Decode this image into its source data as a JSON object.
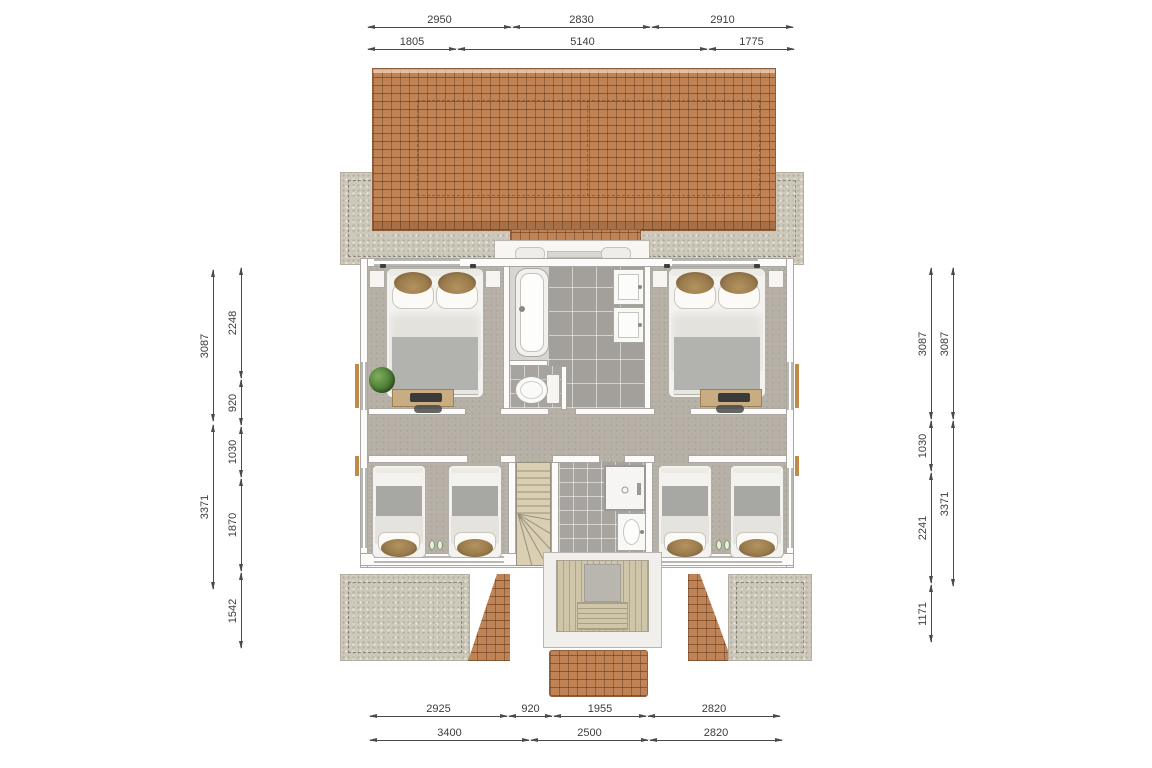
{
  "drawing": {
    "type": "floor-plan",
    "units": "mm"
  },
  "palette": {
    "roof_tile": "#c08355",
    "concrete": "#cdc8ba",
    "room_floor": "#b5afa5",
    "bath_tile": "#a3a09b",
    "stair_wood": "#d9cdb2",
    "deck_wood": "#cfc5a8",
    "wall": "#fcfbf9",
    "desk_wood": "#c9ad82",
    "dimension_text": "#3c3c3c",
    "window_post": "#c08948"
  },
  "dims": {
    "top_row1": [
      "2950",
      "2830",
      "2910"
    ],
    "top_row2": [
      "1805",
      "5140",
      "1775"
    ],
    "bottom_row1": [
      "2925",
      "920",
      "1955",
      "2820"
    ],
    "bottom_row2": [
      "3400",
      "2500",
      "2820"
    ],
    "left_outer": [
      "3087",
      "3371"
    ],
    "left_inner": [
      "2248",
      "920",
      "1030",
      "1870",
      "1542"
    ],
    "right_inner": [
      "3087",
      "1030",
      "2241",
      "1171"
    ],
    "right_outer": [
      "3087",
      "3371"
    ]
  }
}
